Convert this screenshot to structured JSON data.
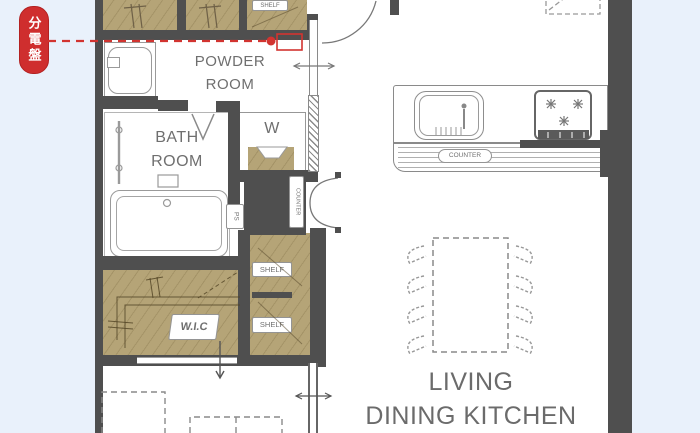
{
  "annotation": {
    "distribution_board_badge": "分電盤",
    "accent_red": "#cf2e2e"
  },
  "floorplan": {
    "rooms": {
      "powder_room": {
        "line1": "POWDER",
        "line2": "ROOM"
      },
      "bath_room": {
        "line1": "BATH",
        "line2": "ROOM"
      },
      "living_dining_kitchen": {
        "line1": "LIVING",
        "line2": "DINING KITCHEN"
      }
    },
    "labels": {
      "shelf_top": "SHELF",
      "shelf_upper": "SHELF",
      "shelf_lower": "SHELF",
      "washer": "W",
      "pipe_space": "PS",
      "closet_counter": "COUNTER",
      "kitchen_counter": "COUNTER",
      "walk_in_closet": "W.I.C"
    },
    "colors": {
      "page_background": "#e9f1fb",
      "floor": "#ffffff",
      "wall": "#4f4f4f",
      "closet_fill": "#b5a477",
      "text": "#6f6f6f"
    }
  }
}
